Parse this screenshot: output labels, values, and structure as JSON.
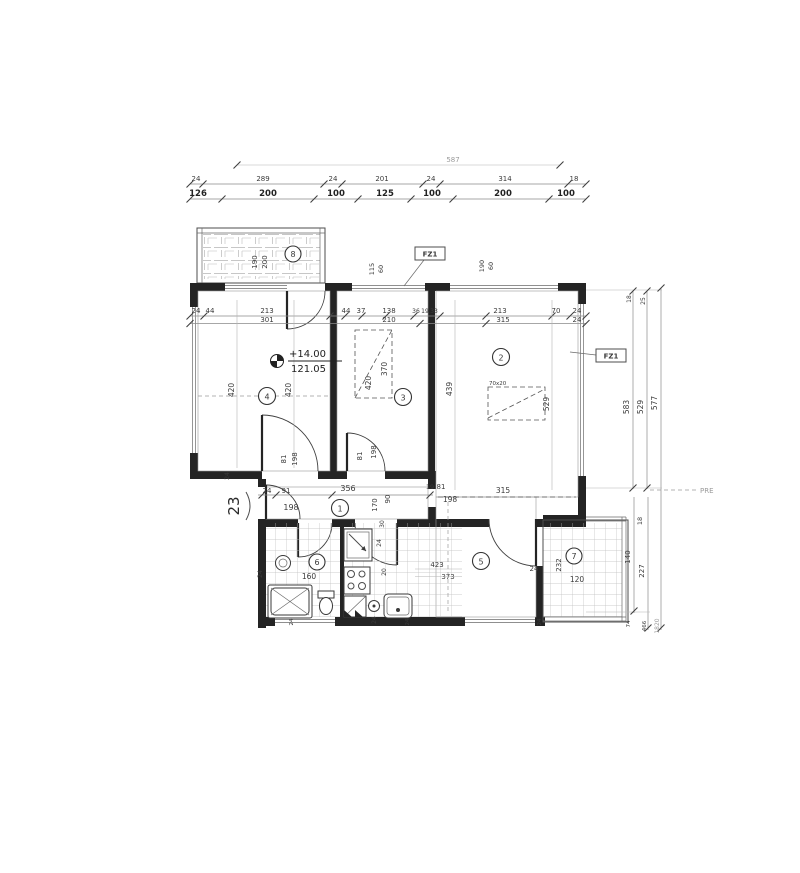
{
  "colors": {
    "ink": "#242424",
    "dim_text": "#3a3a3a",
    "grey_text": "#9a9a9a",
    "paper": "#ffffff"
  },
  "top": {
    "total": "587",
    "row1": [
      "24",
      "289",
      "24",
      "201",
      "24",
      "314",
      "18"
    ],
    "row2": [
      "126",
      "200",
      "100",
      "125",
      "100",
      "200",
      "100"
    ]
  },
  "mid": {
    "row1": [
      "24",
      "44",
      "213",
      "44",
      "37",
      "138",
      "36",
      "19",
      "33",
      "213",
      "70",
      "24"
    ],
    "row2": [
      "301",
      "210",
      "315",
      "24"
    ]
  },
  "rooms": {
    "r1": "1",
    "r2": "2",
    "r3": "3",
    "r4": "4",
    "r5": "5",
    "r6": "6",
    "r7": "7",
    "r8": "8"
  },
  "balcony8": {
    "d1": "190",
    "d2": "200"
  },
  "shafts": {
    "l1": "115",
    "l2": "60",
    "r1": "190",
    "r2": "60"
  },
  "labels": {
    "fz1": "FZ1",
    "pre": "PRE",
    "section": "23",
    "elev_top": "+14.00",
    "elev_bot": "121.05",
    "bed": "70x20",
    "leftsm": "24"
  },
  "room4": {
    "v1": "420",
    "v2": "420",
    "door_w": "81",
    "door_h": "198"
  },
  "room3": {
    "v1": "420",
    "v2": "370",
    "door_w": "81",
    "door_h": "198"
  },
  "room2": {
    "v1": "439",
    "v2": "529",
    "bottom": "315"
  },
  "hall": {
    "d24": "24",
    "d91": "91",
    "d198": "198",
    "d356": "356",
    "d170": "170",
    "d90": "90",
    "d19": "19",
    "d81": "81",
    "d198b": "198",
    "d30": "30",
    "d24b": "24"
  },
  "bath": {
    "d160": "160",
    "d24": "24"
  },
  "kitchen": {
    "d423": "423",
    "d373": "373",
    "d20": "20",
    "d24": "24"
  },
  "room5": {
    "d24": "24"
  },
  "room7": {
    "d232": "232",
    "d120": "120"
  },
  "right": {
    "t18": "18",
    "t25": "25",
    "v583": "583",
    "v529": "529",
    "v577": "577",
    "l18": "18",
    "l140": "140",
    "l227": "227",
    "b74": "74",
    "b466": "466",
    "b1820": "1820"
  },
  "bottom_ticks": [
    "24",
    "24",
    "24"
  ]
}
